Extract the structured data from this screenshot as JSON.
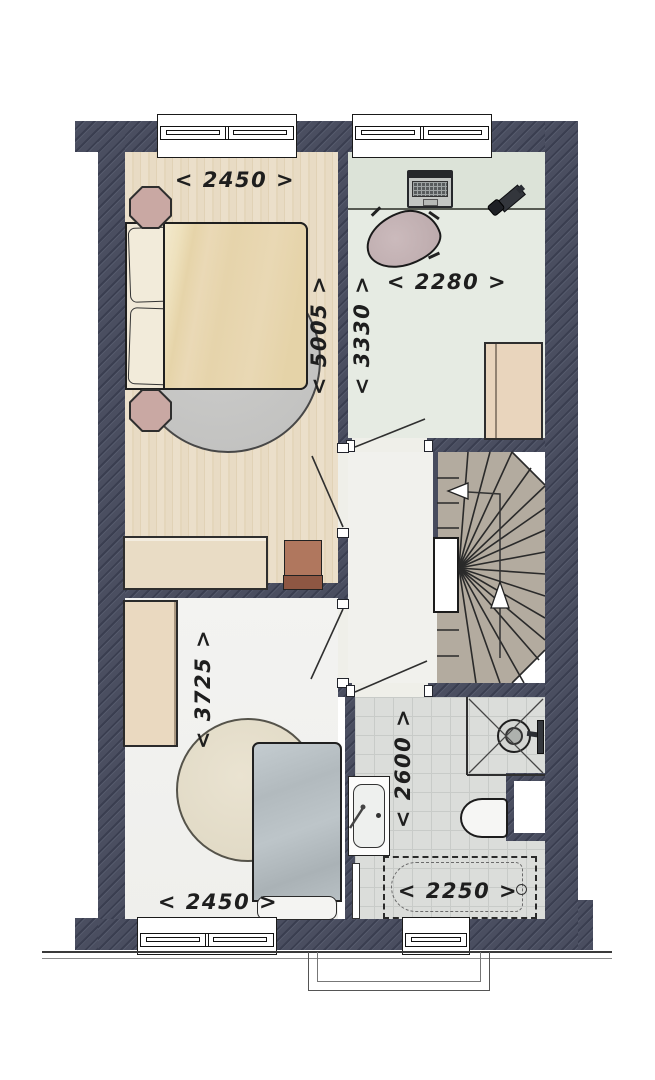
{
  "plan": {
    "type": "residential-floor-plan",
    "dimensions": {
      "bedroom1_width": "< 2450 >",
      "office_width": "< 2280 >",
      "bedroom1_length": "< 5005 >",
      "office_length": "< 3330 >",
      "bedroom2_length": "< 3725 >",
      "bathroom_length": "< 2600 >",
      "bedroom2_width": "< 2450 >",
      "bathtub_width": "< 2250 >"
    },
    "colors": {
      "wall": "#474b5d",
      "wall_hatch_dark": "#3a3e50",
      "wood_floor": "#e8dcc6",
      "office_floor": "#e6ebe3",
      "desk": "#dce3d8",
      "landing_floor": "#f1f1ed",
      "bedroom2_floor": "#f3f3f1",
      "tile_floor": "#dbddda",
      "stair": "#b3ab9f",
      "furniture_beige": "#e9dcc4",
      "nightstand_mauve": "#c9a8a3",
      "office_chair_mauve": "#c5b3b5",
      "duvet_tan": "#e8d7b2",
      "duvet_blue": "#b7bfc3",
      "rug_gray": "#c5c5c3",
      "rug_cream": "#e5decb",
      "chair_brown": "#b0775e"
    }
  }
}
